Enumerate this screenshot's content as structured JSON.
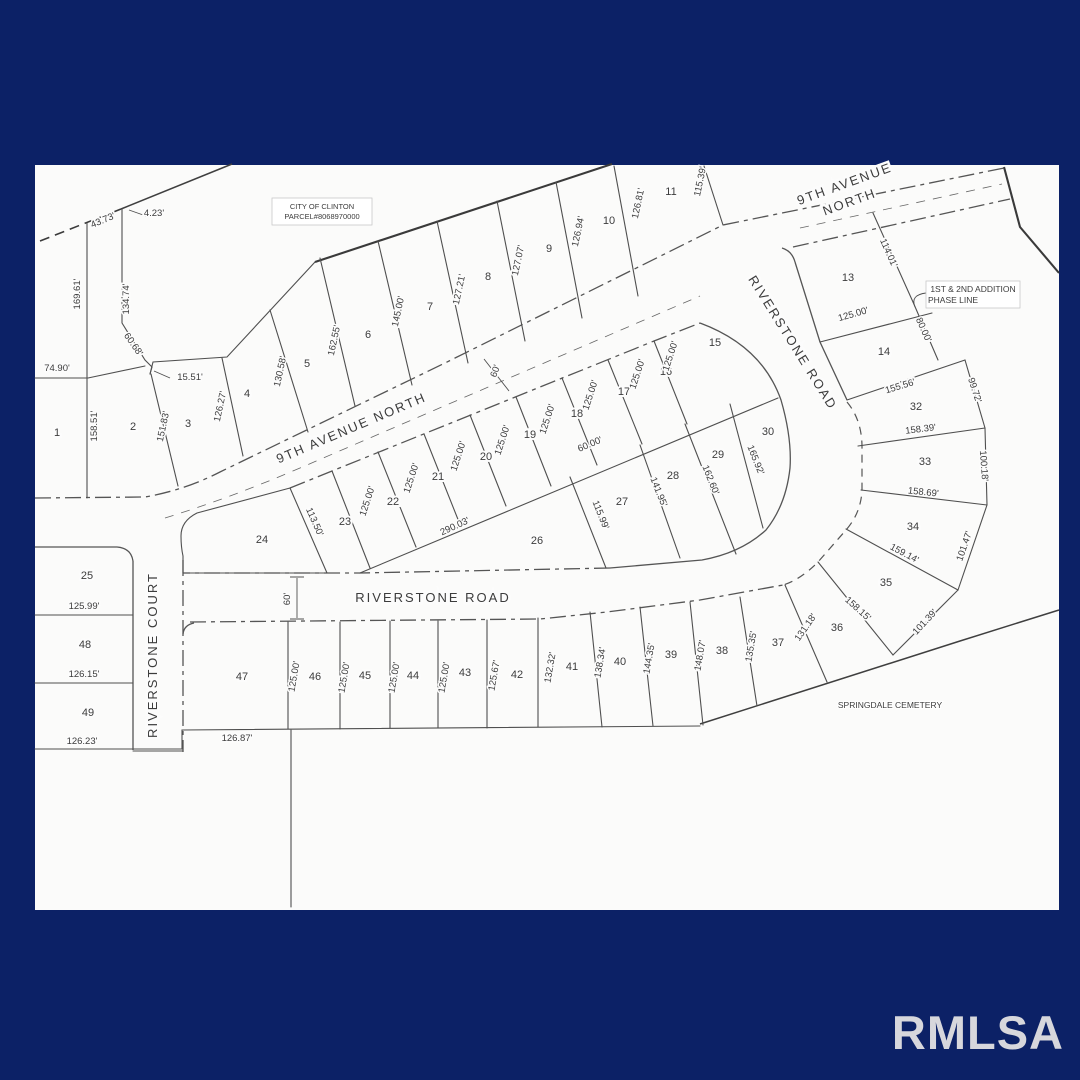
{
  "canvas": {
    "bg": "#0c2166",
    "map_bg": "#fbfbfa",
    "line_color": "#4f4f4f",
    "text_color": "#3c3c3c"
  },
  "watermark": {
    "text": "RMLSA",
    "color": "#d7d7dc"
  },
  "streets": [
    {
      "t": "9TH AVENUE NORTH",
      "x": 353,
      "y": 432,
      "r": -23,
      "s": 14
    },
    {
      "t": "9TH AVENUE",
      "x": 846,
      "y": 188,
      "r": -20,
      "s": 13
    },
    {
      "t": "NORTH",
      "x": 851,
      "y": 206,
      "r": -20,
      "s": 13
    },
    {
      "t": "RIVERSTONE ROAD",
      "x": 789,
      "y": 345,
      "r": 58,
      "s": 13
    },
    {
      "t": "RIVERSTONE ROAD",
      "x": 433,
      "y": 602,
      "r": 0,
      "s": 13.5
    },
    {
      "t": "RIVERSTONE COURT",
      "x": 157,
      "y": 655,
      "r": -90,
      "s": 12.5
    }
  ],
  "lots": [
    {
      "n": "1",
      "x": 57,
      "y": 436
    },
    {
      "n": "2",
      "x": 133,
      "y": 430
    },
    {
      "n": "3",
      "x": 188,
      "y": 427
    },
    {
      "n": "4",
      "x": 247,
      "y": 397
    },
    {
      "n": "5",
      "x": 307,
      "y": 367
    },
    {
      "n": "6",
      "x": 368,
      "y": 338
    },
    {
      "n": "7",
      "x": 430,
      "y": 310
    },
    {
      "n": "8",
      "x": 488,
      "y": 280
    },
    {
      "n": "9",
      "x": 549,
      "y": 252
    },
    {
      "n": "10",
      "x": 609,
      "y": 224
    },
    {
      "n": "11",
      "x": 671,
      "y": 195
    },
    {
      "n": "13",
      "x": 848,
      "y": 281
    },
    {
      "n": "14",
      "x": 884,
      "y": 355
    },
    {
      "n": "15",
      "x": 715,
      "y": 346
    },
    {
      "n": "16",
      "x": 666,
      "y": 375
    },
    {
      "n": "17",
      "x": 624,
      "y": 395
    },
    {
      "n": "18",
      "x": 577,
      "y": 417
    },
    {
      "n": "19",
      "x": 530,
      "y": 438
    },
    {
      "n": "20",
      "x": 486,
      "y": 460
    },
    {
      "n": "21",
      "x": 438,
      "y": 480
    },
    {
      "n": "22",
      "x": 393,
      "y": 505
    },
    {
      "n": "23",
      "x": 345,
      "y": 525
    },
    {
      "n": "24",
      "x": 262,
      "y": 543
    },
    {
      "n": "25",
      "x": 87,
      "y": 579
    },
    {
      "n": "26",
      "x": 537,
      "y": 544
    },
    {
      "n": "27",
      "x": 622,
      "y": 505
    },
    {
      "n": "28",
      "x": 673,
      "y": 479
    },
    {
      "n": "29",
      "x": 718,
      "y": 458
    },
    {
      "n": "30",
      "x": 768,
      "y": 435
    },
    {
      "n": "32",
      "x": 916,
      "y": 410
    },
    {
      "n": "33",
      "x": 925,
      "y": 465
    },
    {
      "n": "34",
      "x": 913,
      "y": 530
    },
    {
      "n": "35",
      "x": 886,
      "y": 586
    },
    {
      "n": "36",
      "x": 837,
      "y": 631
    },
    {
      "n": "37",
      "x": 778,
      "y": 646
    },
    {
      "n": "38",
      "x": 722,
      "y": 654
    },
    {
      "n": "39",
      "x": 671,
      "y": 658
    },
    {
      "n": "40",
      "x": 620,
      "y": 665
    },
    {
      "n": "41",
      "x": 572,
      "y": 670
    },
    {
      "n": "42",
      "x": 517,
      "y": 678
    },
    {
      "n": "43",
      "x": 465,
      "y": 676
    },
    {
      "n": "44",
      "x": 413,
      "y": 679
    },
    {
      "n": "45",
      "x": 365,
      "y": 679
    },
    {
      "n": "46",
      "x": 315,
      "y": 680
    },
    {
      "n": "47",
      "x": 242,
      "y": 680
    },
    {
      "n": "48",
      "x": 85,
      "y": 648
    },
    {
      "n": "49",
      "x": 88,
      "y": 716
    }
  ],
  "dimensions": [
    {
      "t": "43.73'",
      "x": 104,
      "y": 223,
      "r": -23
    },
    {
      "t": "4.23'",
      "x": 154,
      "y": 216,
      "r": 0
    },
    {
      "t": "169.61'",
      "x": 80,
      "y": 294,
      "r": -90
    },
    {
      "t": "134.74'",
      "x": 129,
      "y": 299,
      "r": -90
    },
    {
      "t": "74.90'",
      "x": 57,
      "y": 371,
      "r": 0
    },
    {
      "t": "60.68'",
      "x": 131,
      "y": 346,
      "r": 55
    },
    {
      "t": "15.51'",
      "x": 190,
      "y": 380,
      "r": 0
    },
    {
      "t": "158.51'",
      "x": 97,
      "y": 426,
      "r": -90
    },
    {
      "t": "151.83'",
      "x": 166,
      "y": 427,
      "r": -78
    },
    {
      "t": "126.27'",
      "x": 223,
      "y": 407,
      "r": -78
    },
    {
      "t": "130.58'",
      "x": 283,
      "y": 372,
      "r": -78
    },
    {
      "t": "162.55'",
      "x": 337,
      "y": 341,
      "r": -78
    },
    {
      "t": "145.00'",
      "x": 401,
      "y": 312,
      "r": -78
    },
    {
      "t": "127.21'",
      "x": 462,
      "y": 290,
      "r": -78
    },
    {
      "t": "127.07'",
      "x": 521,
      "y": 261,
      "r": -78
    },
    {
      "t": "126.94'",
      "x": 581,
      "y": 232,
      "r": -78
    },
    {
      "t": "126.81'",
      "x": 641,
      "y": 204,
      "r": -78
    },
    {
      "t": "115.39'",
      "x": 703,
      "y": 182,
      "r": -78
    },
    {
      "t": "114.01'",
      "x": 886,
      "y": 254,
      "r": 66
    },
    {
      "t": "125.00'",
      "x": 854,
      "y": 317,
      "r": -16
    },
    {
      "t": "80.00'",
      "x": 921,
      "y": 331,
      "r": 66
    },
    {
      "t": "155.56'",
      "x": 901,
      "y": 389,
      "r": -17
    },
    {
      "t": "99.72'",
      "x": 972,
      "y": 391,
      "r": 72
    },
    {
      "t": "158.39'",
      "x": 921,
      "y": 432,
      "r": -7
    },
    {
      "t": "100.18'",
      "x": 981,
      "y": 466,
      "r": 86
    },
    {
      "t": "158.69'",
      "x": 923,
      "y": 495,
      "r": 6
    },
    {
      "t": "101.47'",
      "x": 967,
      "y": 547,
      "r": -71
    },
    {
      "t": "159.14'",
      "x": 903,
      "y": 556,
      "r": 28
    },
    {
      "t": "158.15'",
      "x": 856,
      "y": 611,
      "r": 42
    },
    {
      "t": "101.39'",
      "x": 927,
      "y": 624,
      "r": -47
    },
    {
      "t": "165.92'",
      "x": 753,
      "y": 461,
      "r": 68
    },
    {
      "t": "162.60'",
      "x": 708,
      "y": 481,
      "r": 68
    },
    {
      "t": "141.95'",
      "x": 656,
      "y": 493,
      "r": 68
    },
    {
      "t": "115.99'",
      "x": 598,
      "y": 516,
      "r": 68
    },
    {
      "t": "60.00'",
      "x": 591,
      "y": 447,
      "r": -23
    },
    {
      "t": "290.03'",
      "x": 456,
      "y": 529,
      "r": -25
    },
    {
      "t": "113.50'",
      "x": 312,
      "y": 523,
      "r": 66
    },
    {
      "t": "125.00'",
      "x": 370,
      "y": 502,
      "r": -72
    },
    {
      "t": "125.00'",
      "x": 414,
      "y": 479,
      "r": -72
    },
    {
      "t": "125.00'",
      "x": 461,
      "y": 457,
      "r": -72
    },
    {
      "t": "125.00'",
      "x": 505,
      "y": 441,
      "r": -72
    },
    {
      "t": "125.00'",
      "x": 550,
      "y": 420,
      "r": -72
    },
    {
      "t": "125.00'",
      "x": 593,
      "y": 396,
      "r": -72
    },
    {
      "t": "125.00'",
      "x": 640,
      "y": 375,
      "r": -72
    },
    {
      "t": "125.00'",
      "x": 673,
      "y": 357,
      "r": -72
    },
    {
      "t": "60'",
      "x": 498,
      "y": 372,
      "r": -70
    },
    {
      "t": "60'",
      "x": 290,
      "y": 599,
      "r": -90
    },
    {
      "t": "125.00'",
      "x": 297,
      "y": 677,
      "r": -80
    },
    {
      "t": "125.00'",
      "x": 347,
      "y": 678,
      "r": -80
    },
    {
      "t": "125.00'",
      "x": 397,
      "y": 678,
      "r": -80
    },
    {
      "t": "125.00'",
      "x": 447,
      "y": 678,
      "r": -80
    },
    {
      "t": "125.67'",
      "x": 497,
      "y": 676,
      "r": -80
    },
    {
      "t": "132.32'",
      "x": 553,
      "y": 668,
      "r": -80
    },
    {
      "t": "138.34'",
      "x": 603,
      "y": 663,
      "r": -80
    },
    {
      "t": "144.35'",
      "x": 652,
      "y": 659,
      "r": -80
    },
    {
      "t": "148.07'",
      "x": 703,
      "y": 656,
      "r": -80
    },
    {
      "t": "135.35'",
      "x": 754,
      "y": 647,
      "r": -80
    },
    {
      "t": "131.18'",
      "x": 808,
      "y": 629,
      "r": -55
    },
    {
      "t": "126.87'",
      "x": 237,
      "y": 741,
      "r": 0
    },
    {
      "t": "125.99'",
      "x": 84,
      "y": 609,
      "r": 0
    },
    {
      "t": "126.15'",
      "x": 84,
      "y": 677,
      "r": 0
    },
    {
      "t": "126.23'",
      "x": 82,
      "y": 744,
      "r": 0
    }
  ],
  "notes": [
    {
      "t": "CITY OF CLINTON",
      "x": 322,
      "y": 209,
      "s": 7.5
    },
    {
      "t": "PARCEL#8068970000",
      "x": 322,
      "y": 219,
      "s": 7.5
    },
    {
      "t": "1ST & 2ND ADDITION",
      "x": 973,
      "y": 292,
      "s": 8.5
    },
    {
      "t": "PHASE LINE",
      "x": 953,
      "y": 303,
      "s": 8.5
    },
    {
      "t": "SPRINGDALE CEMETERY",
      "x": 890,
      "y": 708,
      "s": 8.5
    }
  ]
}
